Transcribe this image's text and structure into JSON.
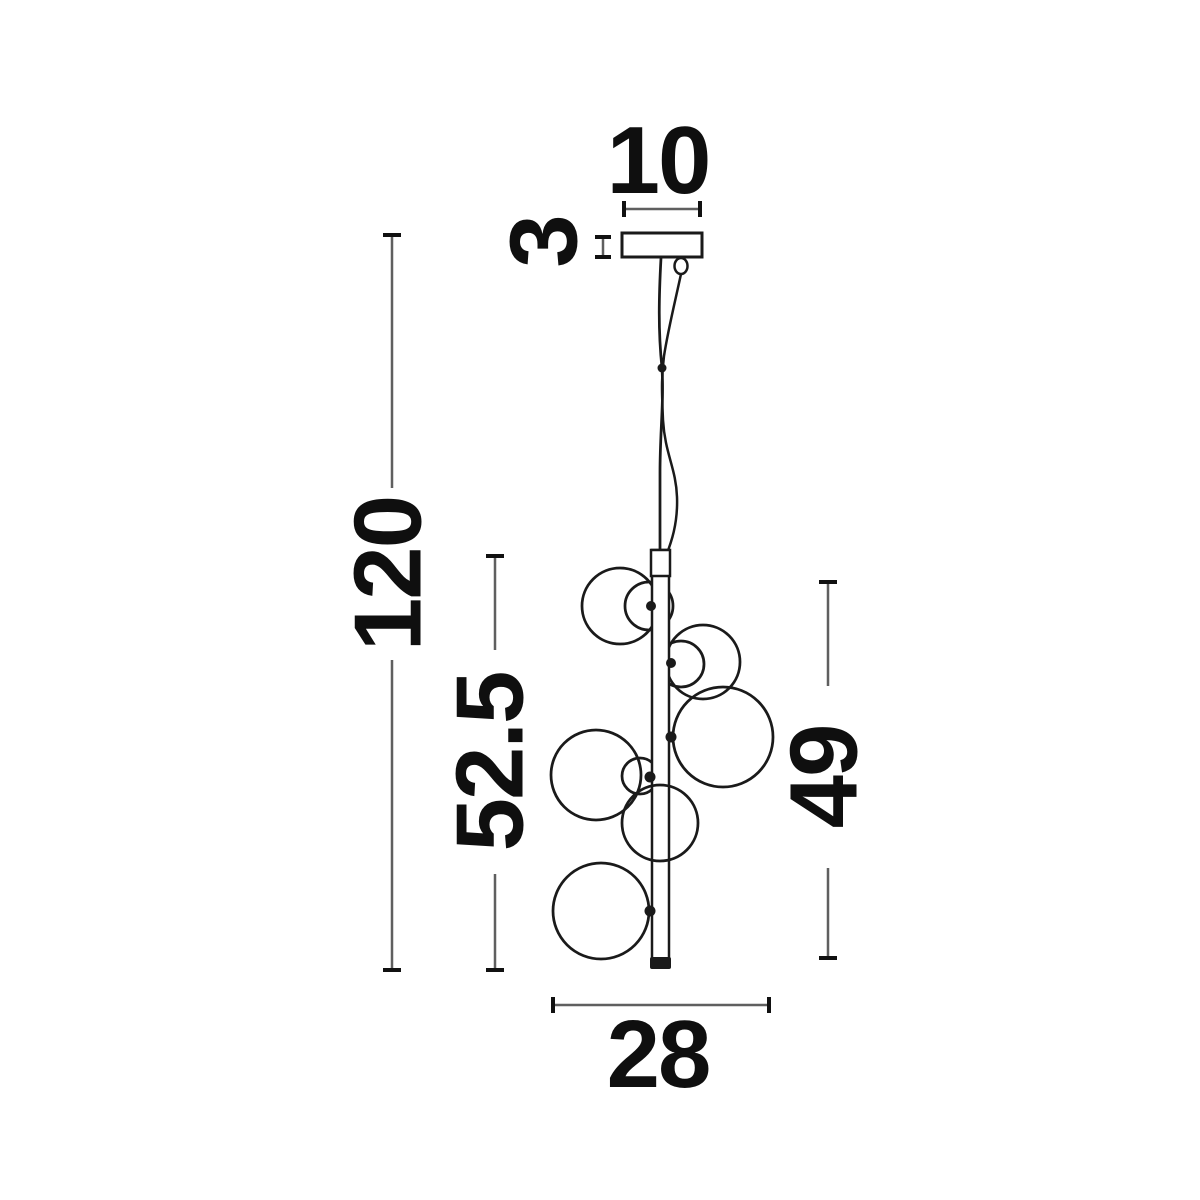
{
  "drawing": {
    "type": "pendant-lamp-dimension-diagram",
    "dimensions": {
      "canopy_width": "10",
      "canopy_height": "3",
      "total_height": "120",
      "stem_height": "52.5",
      "cluster_height": "49",
      "fixture_width": "28"
    },
    "colors": {
      "line": "#1a1a1a",
      "dim_line": "#5f5f5f",
      "tick": "#111111",
      "text": "#0f0f0f",
      "background": "#ffffff"
    }
  }
}
